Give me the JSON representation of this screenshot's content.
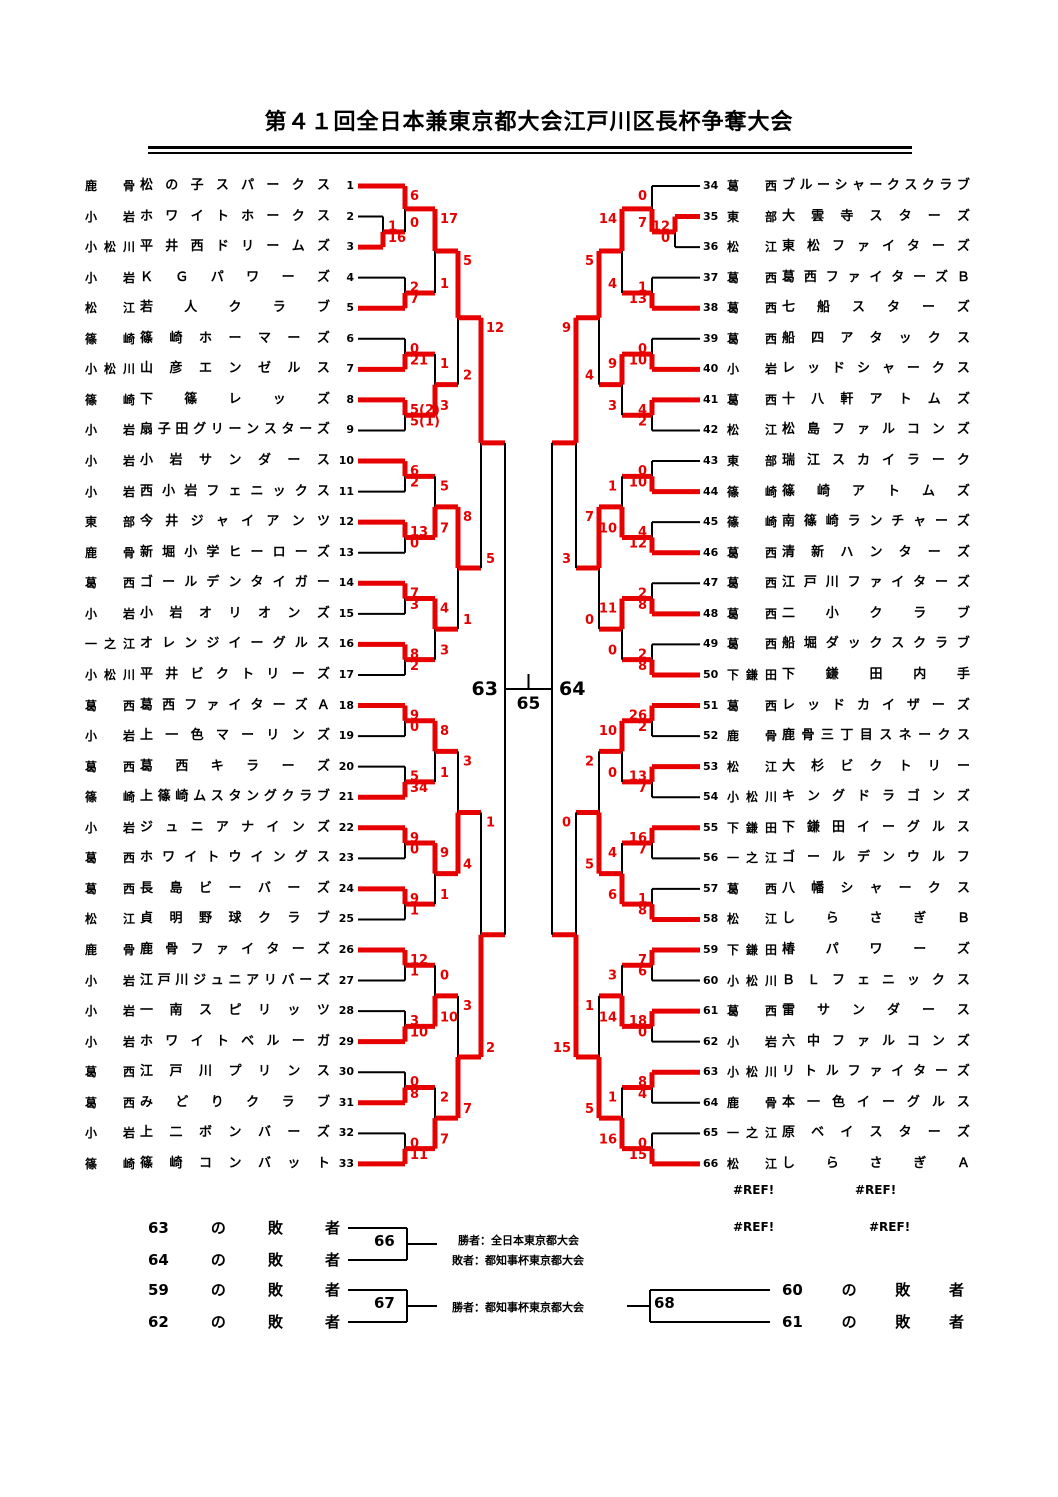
{
  "title": "第４１回全日本兼東京都大会江戸川区長杯争奪大会",
  "colors": {
    "red": "#e60000",
    "black": "#000000"
  },
  "teams": {
    "left": [
      {
        "seed": 1,
        "region": "鹿骨",
        "name": "松の子スパークス"
      },
      {
        "seed": 2,
        "region": "小岩",
        "name": "ホワイトホークス"
      },
      {
        "seed": 3,
        "region": "小松川",
        "name": "平井西ドリームズ"
      },
      {
        "seed": 4,
        "region": "小岩",
        "name": "ＫＧパワーズ"
      },
      {
        "seed": 5,
        "region": "松江",
        "name": "若人クラブ"
      },
      {
        "seed": 6,
        "region": "篠崎",
        "name": "篠崎ホーマーズ"
      },
      {
        "seed": 7,
        "region": "小松川",
        "name": "山彦エンゼルス"
      },
      {
        "seed": 8,
        "region": "篠崎",
        "name": "下篠レッズ"
      },
      {
        "seed": 9,
        "region": "小岩",
        "name": "扇子田グリーンスターズ"
      },
      {
        "seed": 10,
        "region": "小岩",
        "name": "小岩サンダース"
      },
      {
        "seed": 11,
        "region": "小岩",
        "name": "西小岩フェニックス"
      },
      {
        "seed": 12,
        "region": "東部",
        "name": "今井ジャイアンツ"
      },
      {
        "seed": 13,
        "region": "鹿骨",
        "name": "新堀小学ヒーローズ"
      },
      {
        "seed": 14,
        "region": "葛西",
        "name": "ゴールデンタイガー"
      },
      {
        "seed": 15,
        "region": "小岩",
        "name": "小岩オリオンズ"
      },
      {
        "seed": 16,
        "region": "一之江",
        "name": "オレンジイーグルス"
      },
      {
        "seed": 17,
        "region": "小松川",
        "name": "平井ビクトリーズ"
      },
      {
        "seed": 18,
        "region": "葛西",
        "name": "葛西ファイターズＡ"
      },
      {
        "seed": 19,
        "region": "小岩",
        "name": "上一色マーリンズ"
      },
      {
        "seed": 20,
        "region": "葛西",
        "name": "葛西キラーズ"
      },
      {
        "seed": 21,
        "region": "篠崎",
        "name": "上篠崎ムスタングクラブ"
      },
      {
        "seed": 22,
        "region": "小岩",
        "name": "ジュニアナインズ"
      },
      {
        "seed": 23,
        "region": "葛西",
        "name": "ホワイトウイングス"
      },
      {
        "seed": 24,
        "region": "葛西",
        "name": "長島ビーバーズ"
      },
      {
        "seed": 25,
        "region": "松江",
        "name": "貞明野球クラブ"
      },
      {
        "seed": 26,
        "region": "鹿骨",
        "name": "鹿骨ファイターズ"
      },
      {
        "seed": 27,
        "region": "小岩",
        "name": "江戸川ジュニアリバーズ"
      },
      {
        "seed": 28,
        "region": "小岩",
        "name": "一南スピリッツ"
      },
      {
        "seed": 29,
        "region": "小岩",
        "name": "ホワイトベルーガ"
      },
      {
        "seed": 30,
        "region": "葛西",
        "name": "江戸川プリンス"
      },
      {
        "seed": 31,
        "region": "葛西",
        "name": "みどりクラブ"
      },
      {
        "seed": 32,
        "region": "小岩",
        "name": "上二ボンバーズ"
      },
      {
        "seed": 33,
        "region": "篠崎",
        "name": "篠崎コンバット"
      }
    ],
    "right": [
      {
        "seed": 34,
        "region": "葛西",
        "name": "ブルーシャークスクラブ"
      },
      {
        "seed": 35,
        "region": "東部",
        "name": "大雲寺スターズ"
      },
      {
        "seed": 36,
        "region": "松江",
        "name": "東松ファイターズ"
      },
      {
        "seed": 37,
        "region": "葛西",
        "name": "葛西ファイターズＢ"
      },
      {
        "seed": 38,
        "region": "葛西",
        "name": "七船スターズ"
      },
      {
        "seed": 39,
        "region": "葛西",
        "name": "船四アタックス"
      },
      {
        "seed": 40,
        "region": "小岩",
        "name": "レッドシャークス"
      },
      {
        "seed": 41,
        "region": "葛西",
        "name": "十八軒アトムズ"
      },
      {
        "seed": 42,
        "region": "松江",
        "name": "松島ファルコンズ"
      },
      {
        "seed": 43,
        "region": "東部",
        "name": "瑞江スカイラーク"
      },
      {
        "seed": 44,
        "region": "篠崎",
        "name": "篠崎アトムズ"
      },
      {
        "seed": 45,
        "region": "篠崎",
        "name": "南篠崎ランチャーズ"
      },
      {
        "seed": 46,
        "region": "葛西",
        "name": "清新ハンターズ"
      },
      {
        "seed": 47,
        "region": "葛西",
        "name": "江戸川ファイターズ"
      },
      {
        "seed": 48,
        "region": "葛西",
        "name": "二小クラブ"
      },
      {
        "seed": 49,
        "region": "葛西",
        "name": "船堀ダックスクラブ"
      },
      {
        "seed": 50,
        "region": "下鎌田",
        "name": "下鎌田内手"
      },
      {
        "seed": 51,
        "region": "葛西",
        "name": "レッドカイザーズ"
      },
      {
        "seed": 52,
        "region": "鹿骨",
        "name": "鹿骨三丁目スネークス"
      },
      {
        "seed": 53,
        "region": "松江",
        "name": "大杉ビクトリー"
      },
      {
        "seed": 54,
        "region": "小松川",
        "name": "キングドラゴンズ"
      },
      {
        "seed": 55,
        "region": "下鎌田",
        "name": "下鎌田イーグルス"
      },
      {
        "seed": 56,
        "region": "一之江",
        "name": "ゴールデンウルフ"
      },
      {
        "seed": 57,
        "region": "葛西",
        "name": "八幡シャークス"
      },
      {
        "seed": 58,
        "region": "松江",
        "name": "しらさぎＢ"
      },
      {
        "seed": 59,
        "region": "下鎌田",
        "name": "椿パワーズ"
      },
      {
        "seed": 60,
        "region": "小松川",
        "name": "ＢＬフェニックス"
      },
      {
        "seed": 61,
        "region": "葛西",
        "name": "雷サンダース"
      },
      {
        "seed": 62,
        "region": "小岩",
        "name": "六中ファルコンズ"
      },
      {
        "seed": 63,
        "region": "小松川",
        "name": "リトルファイターズ"
      },
      {
        "seed": 64,
        "region": "鹿骨",
        "name": "本一色イーグルス"
      },
      {
        "seed": 65,
        "region": "一之江",
        "name": "原ベイスターズ"
      },
      {
        "seed": 66,
        "region": "松江",
        "name": "しらさぎＡ"
      }
    ]
  },
  "bracket": {
    "left": {
      "matches": [
        {
          "id": "a",
          "x": 383,
          "t": 2,
          "b": 3,
          "st": "1",
          "sb": "16",
          "w": "b"
        },
        {
          "id": "b",
          "x": 405,
          "t": 1,
          "b": "a",
          "st": "6",
          "sb": "0",
          "w": "t"
        },
        {
          "id": "c",
          "x": 405,
          "t": 4,
          "b": 5,
          "st": "2",
          "sb": "7",
          "w": "b"
        },
        {
          "id": "d",
          "x": 435,
          "t": "b",
          "b": "c",
          "st": "17",
          "sb": "1",
          "w": "t"
        },
        {
          "id": "e",
          "x": 405,
          "t": 6,
          "b": 7,
          "st": "0",
          "sb": "21",
          "w": "b"
        },
        {
          "id": "f",
          "x": 405,
          "t": 8,
          "b": 9,
          "st": "5(2)",
          "sb": "5(1)",
          "w": "t"
        },
        {
          "id": "g",
          "x": 435,
          "t": "e",
          "b": "f",
          "st": "1",
          "sb": "3",
          "w": "b"
        },
        {
          "id": "h",
          "x": 458,
          "t": "d",
          "b": "g",
          "st": "5",
          "sb": "2",
          "w": "t"
        },
        {
          "id": "j",
          "x": 405,
          "t": 10,
          "b": 11,
          "st": "6",
          "sb": "2",
          "w": "t"
        },
        {
          "id": "k",
          "x": 405,
          "t": 12,
          "b": 13,
          "st": "13",
          "sb": "0",
          "w": "t"
        },
        {
          "id": "l",
          "x": 435,
          "t": "j",
          "b": "k",
          "st": "5",
          "sb": "7",
          "w": "b"
        },
        {
          "id": "n",
          "x": 405,
          "t": 14,
          "b": 15,
          "st": "7",
          "sb": "3",
          "w": "t"
        },
        {
          "id": "o",
          "x": 405,
          "t": 16,
          "b": 17,
          "st": "8",
          "sb": "2",
          "w": "t"
        },
        {
          "id": "m",
          "x": 435,
          "t": "n",
          "b": "o",
          "st": "4",
          "sb": "3",
          "w": "t"
        },
        {
          "id": "p",
          "x": 458,
          "t": "l",
          "b": "m",
          "st": "8",
          "sb": "1",
          "w": "t"
        },
        {
          "id": "i",
          "x": 481,
          "t": "h",
          "b": "p",
          "st": "12",
          "sb": "5",
          "w": "t"
        },
        {
          "id": "q1",
          "x": 405,
          "t": 18,
          "b": 19,
          "st": "9",
          "sb": "0",
          "w": "t"
        },
        {
          "id": "q2",
          "x": 405,
          "t": 20,
          "b": 21,
          "st": "5",
          "sb": "34",
          "w": "b"
        },
        {
          "id": "s1",
          "x": 435,
          "t": "q1",
          "b": "q2",
          "st": "8",
          "sb": "1",
          "w": "t"
        },
        {
          "id": "q3",
          "x": 405,
          "t": 22,
          "b": 23,
          "st": "9",
          "sb": "0",
          "w": "t"
        },
        {
          "id": "q4",
          "x": 405,
          "t": 24,
          "b": 25,
          "st": "9",
          "sb": "1",
          "w": "t"
        },
        {
          "id": "s2",
          "x": 435,
          "t": "q3",
          "b": "q4",
          "st": "9",
          "sb": "1",
          "w": "t"
        },
        {
          "id": "s",
          "x": 458,
          "t": "s1",
          "b": "s2",
          "st": "3",
          "sb": "4",
          "w": "b"
        },
        {
          "id": "q5",
          "x": 405,
          "t": 26,
          "b": 27,
          "st": "12",
          "sb": "1",
          "w": "t"
        },
        {
          "id": "q6",
          "x": 405,
          "t": 28,
          "b": 29,
          "st": "3",
          "sb": "10",
          "w": "b"
        },
        {
          "id": "s3",
          "x": 435,
          "t": "q5",
          "b": "q6",
          "st": "0",
          "sb": "10",
          "w": "b"
        },
        {
          "id": "q7",
          "x": 405,
          "t": 30,
          "b": 31,
          "st": "0",
          "sb": "8",
          "w": "b"
        },
        {
          "id": "q8",
          "x": 405,
          "t": 32,
          "b": 33,
          "st": "0",
          "sb": "11",
          "w": "b"
        },
        {
          "id": "s4",
          "x": 435,
          "t": "q7",
          "b": "q8",
          "st": "2",
          "sb": "7",
          "w": "b"
        },
        {
          "id": "v",
          "x": 458,
          "t": "s3",
          "b": "s4",
          "st": "3",
          "sb": "7",
          "w": "b"
        },
        {
          "id": "w",
          "x": 481,
          "t": "s",
          "b": "v",
          "st": "1",
          "sb": "2",
          "w": "b"
        },
        {
          "id": "semi",
          "x": 505,
          "t": "i",
          "b": "w",
          "st": "",
          "sb": "",
          "w": null
        }
      ]
    },
    "right": {
      "matches": [
        {
          "id": "a",
          "x": 675,
          "t": 35,
          "b": 36,
          "st": "12",
          "sb": "0",
          "w": "t"
        },
        {
          "id": "b",
          "x": 652,
          "t": 34,
          "b": "a",
          "st": "0",
          "sb": "7",
          "w": "b"
        },
        {
          "id": "c",
          "x": 652,
          "t": 37,
          "b": 38,
          "st": "1",
          "sb": "13",
          "w": "b"
        },
        {
          "id": "d",
          "x": 622,
          "t": "b",
          "b": "c",
          "st": "14",
          "sb": "4",
          "w": "t"
        },
        {
          "id": "e",
          "x": 652,
          "t": 39,
          "b": 40,
          "st": "0",
          "sb": "10",
          "w": "b"
        },
        {
          "id": "f",
          "x": 652,
          "t": 41,
          "b": 42,
          "st": "4",
          "sb": "2",
          "w": "t"
        },
        {
          "id": "g",
          "x": 622,
          "t": "e",
          "b": "f",
          "st": "9",
          "sb": "3",
          "w": "t"
        },
        {
          "id": "h",
          "x": 599,
          "t": "d",
          "b": "g",
          "st": "5",
          "sb": "4",
          "w": "t"
        },
        {
          "id": "j",
          "x": 652,
          "t": 43,
          "b": 44,
          "st": "0",
          "sb": "10",
          "w": "b"
        },
        {
          "id": "k",
          "x": 652,
          "t": 45,
          "b": 46,
          "st": "4",
          "sb": "12",
          "w": "b"
        },
        {
          "id": "l",
          "x": 622,
          "t": "j",
          "b": "k",
          "st": "1",
          "sb": "10",
          "w": "b"
        },
        {
          "id": "n",
          "x": 652,
          "t": 47,
          "b": 48,
          "st": "2",
          "sb": "8",
          "w": "b"
        },
        {
          "id": "o",
          "x": 652,
          "t": 49,
          "b": 50,
          "st": "2",
          "sb": "8",
          "w": "b"
        },
        {
          "id": "m",
          "x": 622,
          "t": "n",
          "b": "o",
          "st": "11",
          "sb": "0",
          "w": "t"
        },
        {
          "id": "p",
          "x": 599,
          "t": "l",
          "b": "m",
          "st": "7",
          "sb": "0",
          "w": "t"
        },
        {
          "id": "i",
          "x": 576,
          "t": "h",
          "b": "p",
          "st": "9",
          "sb": "3",
          "w": "t"
        },
        {
          "id": "q1",
          "x": 652,
          "t": 51,
          "b": 52,
          "st": "26",
          "sb": "2",
          "w": "t"
        },
        {
          "id": "q2",
          "x": 652,
          "t": 53,
          "b": 54,
          "st": "13",
          "sb": "7",
          "w": "t"
        },
        {
          "id": "s1",
          "x": 622,
          "t": "q1",
          "b": "q2",
          "st": "10",
          "sb": "0",
          "w": "t"
        },
        {
          "id": "q3",
          "x": 652,
          "t": 55,
          "b": 56,
          "st": "16",
          "sb": "7",
          "w": "t"
        },
        {
          "id": "q4",
          "x": 652,
          "t": 57,
          "b": 58,
          "st": "1",
          "sb": "8",
          "w": "b"
        },
        {
          "id": "s2",
          "x": 622,
          "t": "q3",
          "b": "q4",
          "st": "4",
          "sb": "6",
          "w": "b"
        },
        {
          "id": "s",
          "x": 599,
          "t": "s1",
          "b": "s2",
          "st": "2",
          "sb": "5",
          "w": "b"
        },
        {
          "id": "q5",
          "x": 652,
          "t": 59,
          "b": 60,
          "st": "7",
          "sb": "6",
          "w": "t"
        },
        {
          "id": "q6",
          "x": 652,
          "t": 61,
          "b": 62,
          "st": "18",
          "sb": "0",
          "w": "t"
        },
        {
          "id": "s3",
          "x": 622,
          "t": "q5",
          "b": "q6",
          "st": "3",
          "sb": "14",
          "w": "b"
        },
        {
          "id": "q7",
          "x": 652,
          "t": 63,
          "b": 64,
          "st": "8",
          "sb": "4",
          "w": "t"
        },
        {
          "id": "q8",
          "x": 652,
          "t": 65,
          "b": 66,
          "st": "0",
          "sb": "15",
          "w": "b"
        },
        {
          "id": "s4",
          "x": 622,
          "t": "q7",
          "b": "q8",
          "st": "1",
          "sb": "16",
          "w": "b"
        },
        {
          "id": "v",
          "x": 599,
          "t": "s3",
          "b": "s4",
          "st": "1",
          "sb": "5",
          "w": "b"
        },
        {
          "id": "w",
          "x": 576,
          "t": "s",
          "b": "v",
          "st": "0",
          "sb": "15",
          "w": "b"
        },
        {
          "id": "semi",
          "x": 552,
          "t": "i",
          "b": "w",
          "st": "",
          "sb": "",
          "w": null
        }
      ]
    }
  },
  "center": {
    "semi_left": "63",
    "semi_right": "64",
    "final": "65"
  },
  "consolation": {
    "loser_suffix": [
      "の",
      "敗",
      "者"
    ],
    "left_rows": [
      "63",
      "64",
      "59",
      "62"
    ],
    "right_rows": [
      "60",
      "61"
    ],
    "boxes": {
      "third_place": "66",
      "consolation_a": "67",
      "consolation_b": "68"
    },
    "notes": {
      "winner_alljapan": "勝者：全日本東京都大会",
      "loser_governor": "敗者：都知事杯東京都大会",
      "winner_governor": "勝者：都知事杯東京都大会"
    },
    "refs": [
      "#REF!",
      "#REF!",
      "#REF!",
      "#REF!"
    ]
  }
}
